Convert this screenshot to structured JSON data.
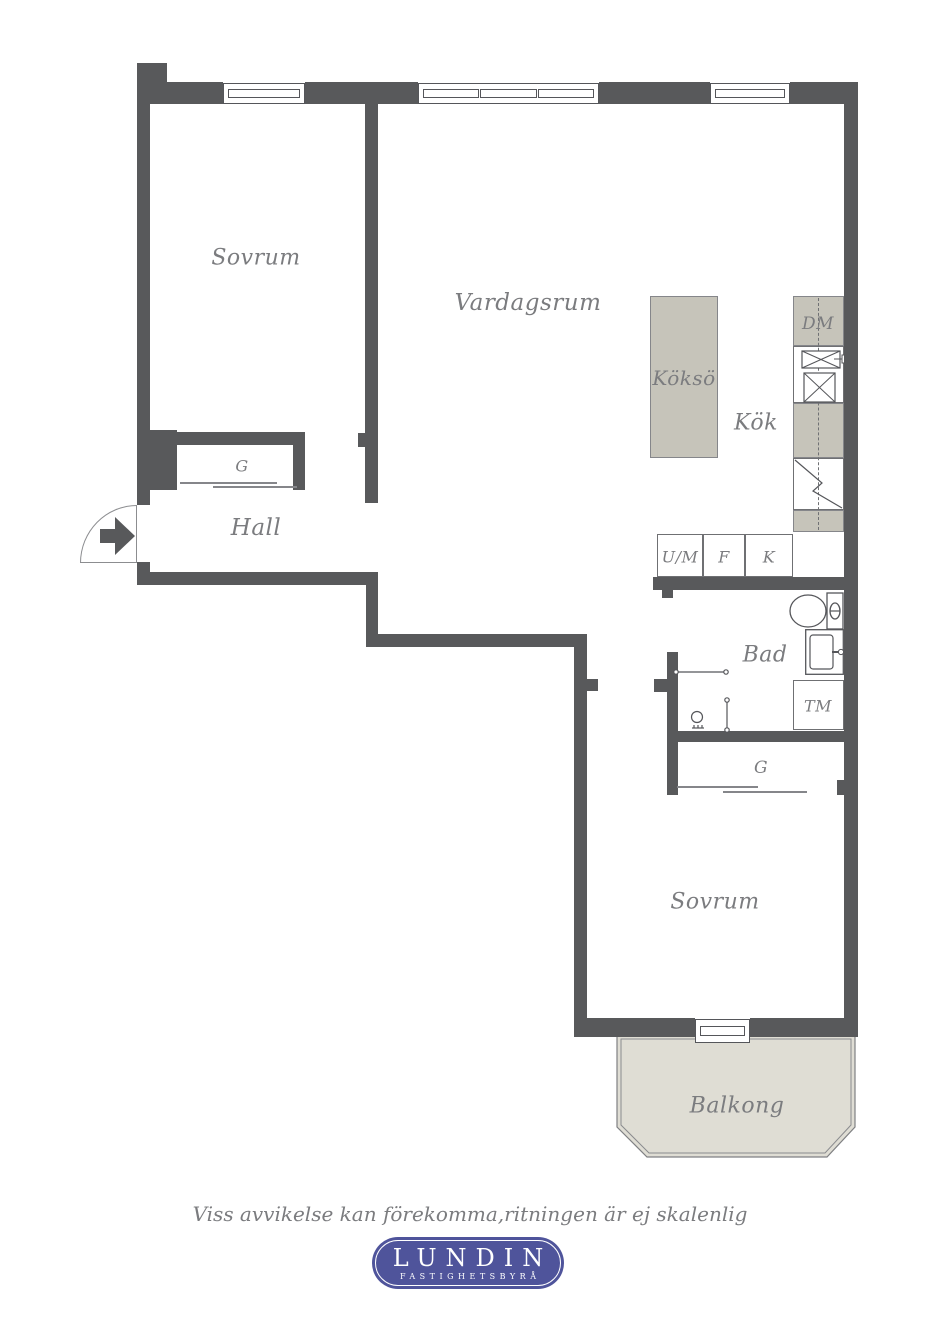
{
  "plan": {
    "rooms": {
      "sovrum_top": "Sovrum",
      "vardagsrum": "Vardagsrum",
      "kokso": "Köksö",
      "kok": "Kök",
      "hall": "Hall",
      "bad": "Bad",
      "sovrum_bottom": "Sovrum",
      "balkong": "Balkong"
    },
    "fixtures": {
      "dishwasher": "DM",
      "washing_machine": "TM",
      "wardrobe_hall": "G",
      "wardrobe_bedroom": "G",
      "oven_microwave": "U/M",
      "freezer": "F",
      "fridge": "K"
    },
    "colors": {
      "wall": "#58595b",
      "furniture": "#c6c4ba",
      "balcony": "#dfddd4",
      "text": "#7b7c7f",
      "logo": "#4f549b"
    }
  },
  "footer": {
    "disclaimer": "Viss avvikelse kan förekomma,ritningen är ej skalenlig",
    "logo": {
      "name": "LUNDIN",
      "subtitle": "FASTIGHETSBYRÅ"
    }
  }
}
